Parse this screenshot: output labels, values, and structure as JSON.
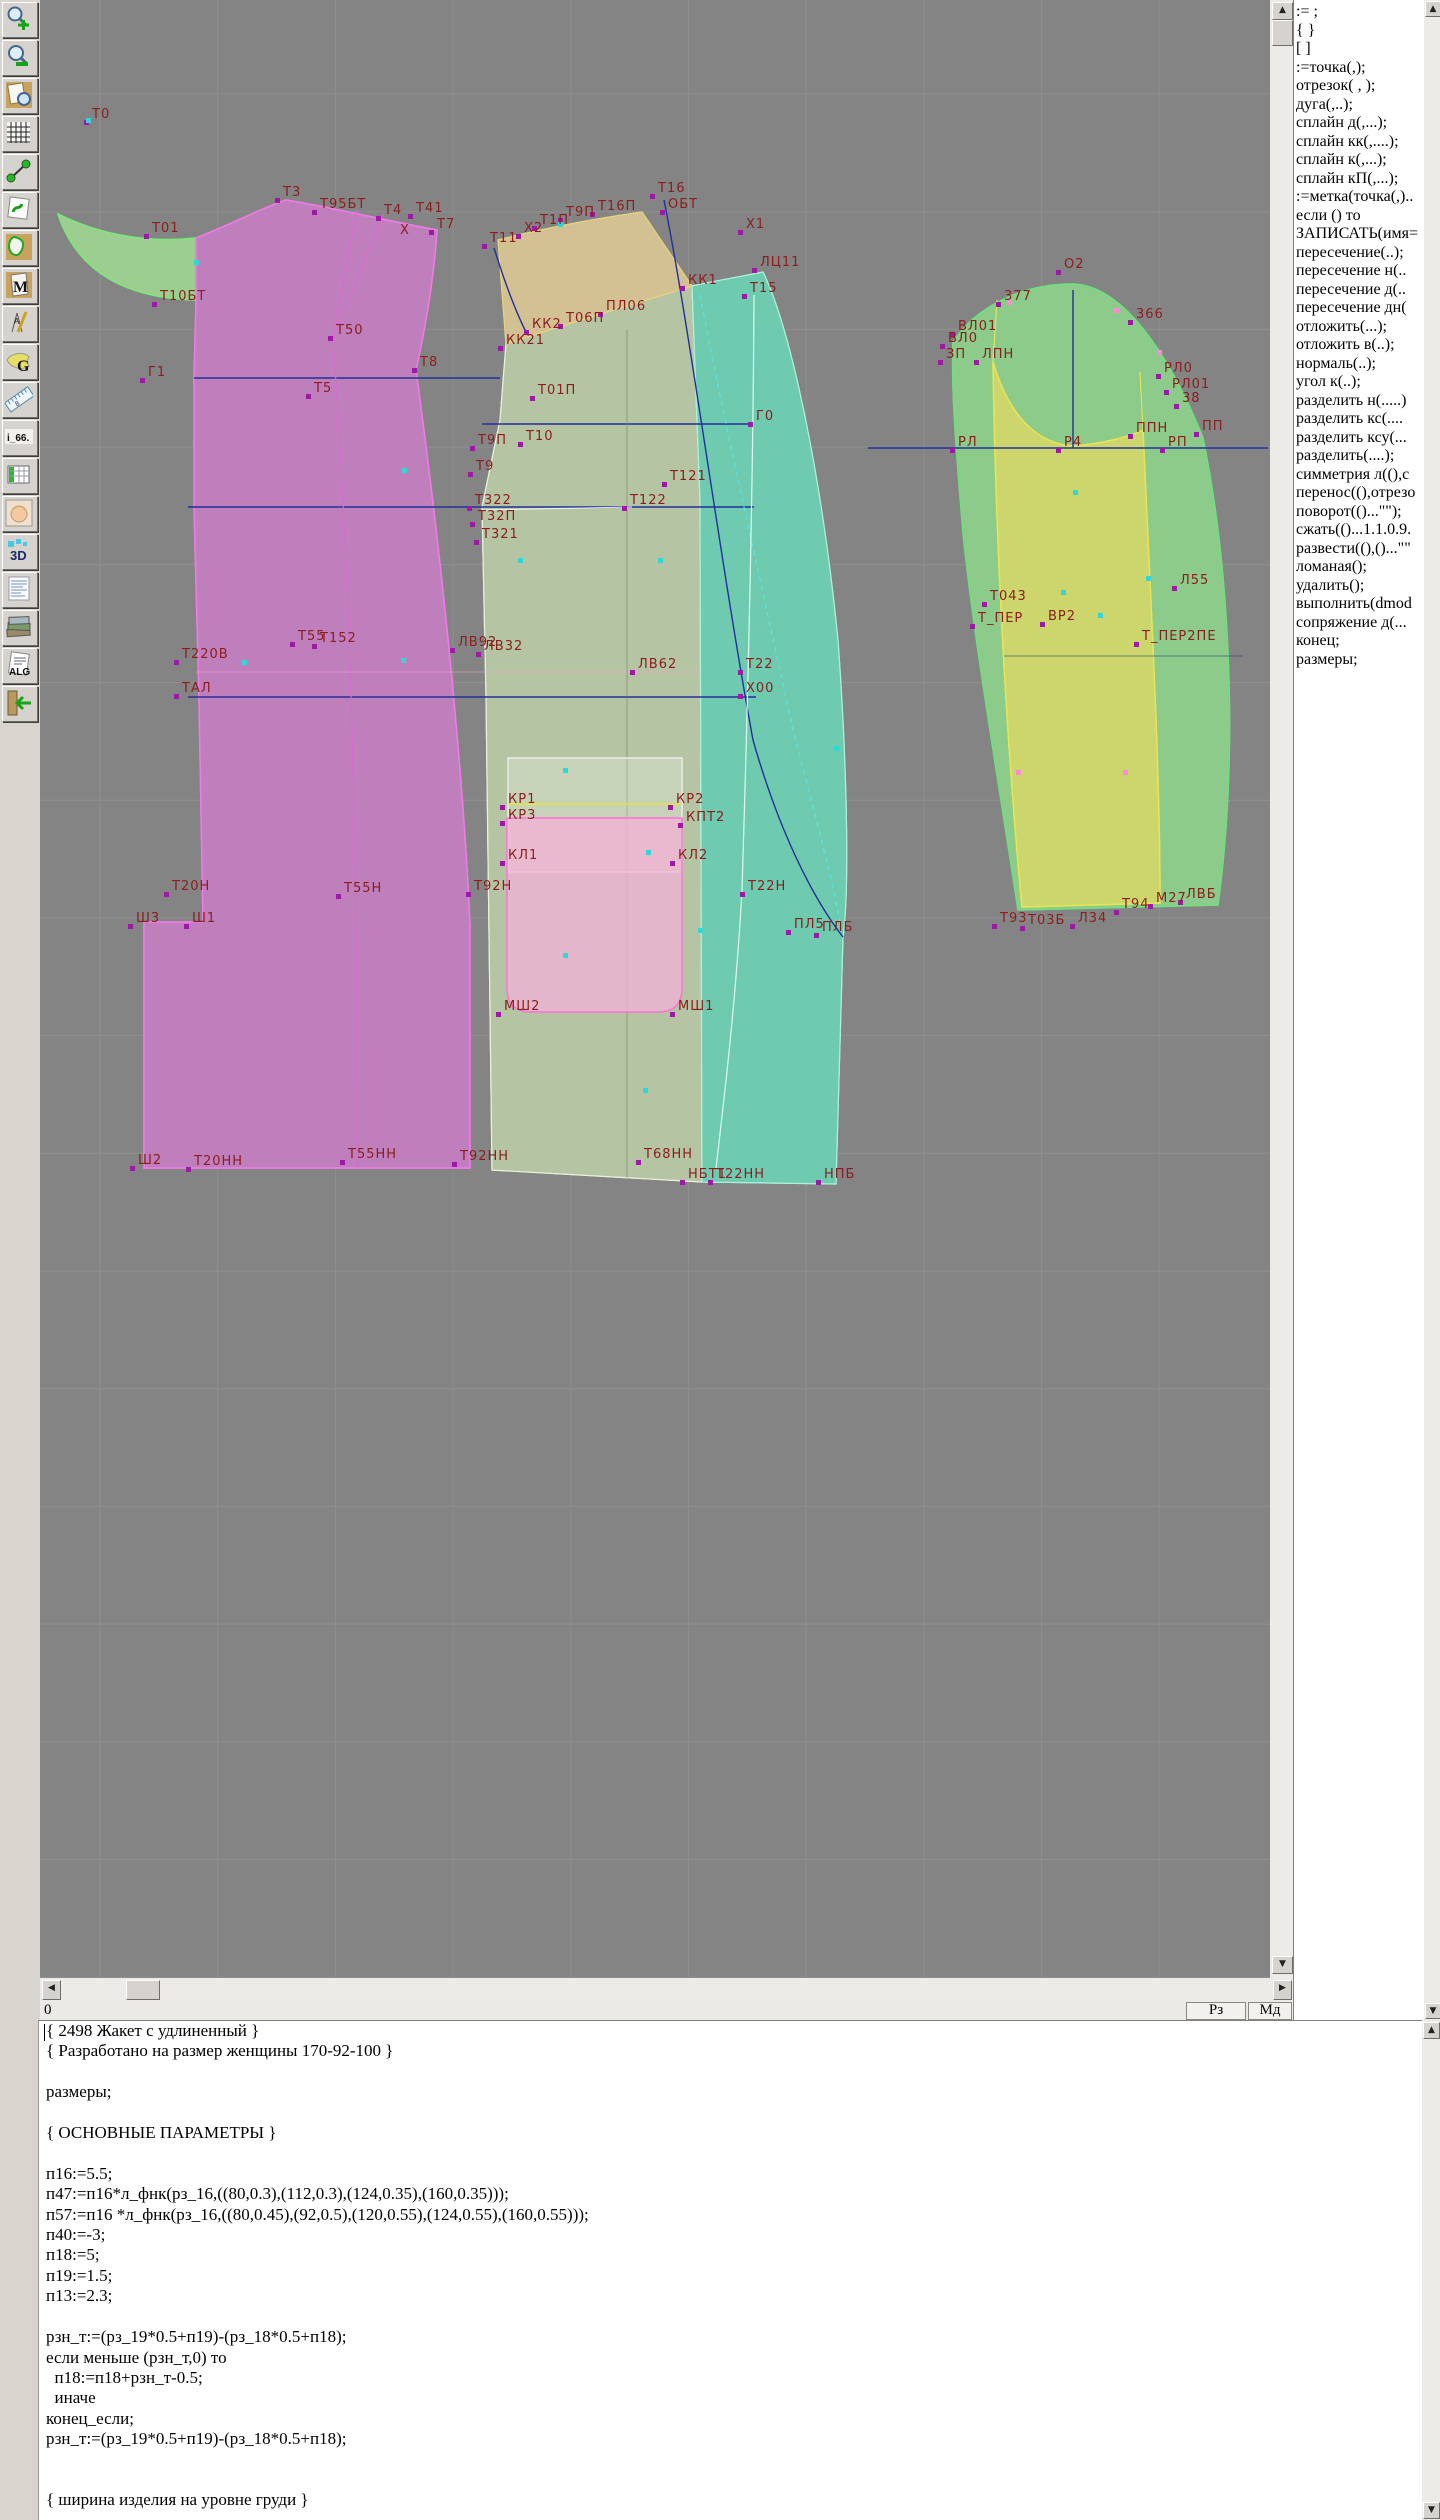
{
  "app": {
    "status_zero": "0",
    "btn_rz": "Рз",
    "btn_md": "Мд",
    "separator": "|"
  },
  "toolbar": {
    "items": [
      {
        "name": "zoom-in-button",
        "label": ""
      },
      {
        "name": "zoom-out-button",
        "label": ""
      },
      {
        "name": "print-preview-button",
        "label": ""
      },
      {
        "name": "grid-button",
        "label": ""
      },
      {
        "name": "measure-button",
        "label": ""
      },
      {
        "name": "sketch-button",
        "label": ""
      },
      {
        "name": "pattern-piece-button",
        "label": ""
      },
      {
        "name": "pattern-m-button",
        "label": "M"
      },
      {
        "name": "drafting-tools-button",
        "label": "A"
      },
      {
        "name": "graphics-g-button",
        "label": "G"
      },
      {
        "name": "ruler-button",
        "label": "8"
      },
      {
        "name": "i66-button",
        "label": "i_66."
      },
      {
        "name": "size-table-button",
        "label": ""
      },
      {
        "name": "model-photo-button",
        "label": ""
      },
      {
        "name": "threed-button",
        "label": "3D"
      },
      {
        "name": "document-list-button",
        "label": ""
      },
      {
        "name": "library-button",
        "label": ""
      },
      {
        "name": "algorithm-button",
        "label": "ALG"
      },
      {
        "name": "exit-button",
        "label": ""
      }
    ]
  },
  "right_panel": {
    "items": [
      ":= ;",
      "{  }",
      "[  ]",
      ":=точка(,);",
      "отрезок( , );",
      "дуга(,..);",
      "сплайн  д(,...);",
      "сплайн  кк(,....);",
      "сплайн  к(,...);",
      "сплайн  кП(,...);",
      ":=метка(точка(,)..",
      "если () то",
      "ЗАПИСАТЬ(имя=",
      "пересечение(..);",
      "пересечение  н(..",
      "пересечение  д(..",
      "пересечение  дн(",
      "отложить(...);",
      "отложить  в(..);",
      "нормаль(..);",
      "угол  к(..);",
      "разделить  н(.....)",
      "разделить  кс(....",
      "разделить  ксу(...",
      "разделить(....);",
      "симметрия  л((),с",
      "перенос((),отрезо",
      "поворот(()...\"\");",
      "сжать(()...1.1.0.9.",
      "развести((),()...\"\"",
      "ломаная();",
      "удалить();",
      "выполнить(dmod",
      "сопряжение  д(...",
      "конец;",
      "размеры;"
    ]
  },
  "canvas": {
    "colors": {
      "bg": "#848484",
      "grid": "#8f8f8f",
      "label": "#8b1d1d",
      "back": "#bf7fbc",
      "collar": "#9ccf8f",
      "side": "#b5c4a2",
      "shoulder": "#d3c193",
      "front": "#6fcbb0",
      "sleeve": "#8ccb8a",
      "undersleeve": "#ccd66b",
      "pocket": "#f0b4d6",
      "navy": "#223099",
      "cyan": "#5ee0dc",
      "magenta_pt": "#a018a8",
      "cyan_pt": "#2fd8d8",
      "pink_pt": "#ff8ad8"
    },
    "labels": [
      [
        "Т0",
        92,
        118
      ],
      [
        "Т3",
        283,
        196
      ],
      [
        "Т95БТ",
        320,
        208
      ],
      [
        "Т4",
        384,
        214
      ],
      [
        "Т41",
        416,
        212
      ],
      [
        "Х",
        400,
        234
      ],
      [
        "Т7",
        437,
        228
      ],
      [
        "Т01",
        152,
        232
      ],
      [
        "Т10БТ",
        160,
        300
      ],
      [
        "Т50",
        336,
        334
      ],
      [
        "Т8",
        420,
        366
      ],
      [
        "Т5",
        314,
        392
      ],
      [
        "Г1",
        148,
        376
      ],
      [
        "Т11",
        490,
        242
      ],
      [
        "Х2",
        524,
        232
      ],
      [
        "Т1П",
        540,
        224
      ],
      [
        "Т9П",
        566,
        216
      ],
      [
        "Т16П",
        598,
        210
      ],
      [
        "Т16",
        658,
        192
      ],
      [
        "ОБТ",
        668,
        208
      ],
      [
        "Х1",
        746,
        228
      ],
      [
        "ЛЦ11",
        760,
        266
      ],
      [
        "Т15",
        750,
        292
      ],
      [
        "КК1",
        688,
        284
      ],
      [
        "КК2",
        532,
        328
      ],
      [
        "КК21",
        506,
        344
      ],
      [
        "Т06П",
        566,
        322
      ],
      [
        "ПЛ06",
        606,
        310
      ],
      [
        "Т01П",
        538,
        394
      ],
      [
        "Т9П",
        478,
        444
      ],
      [
        "Т10",
        526,
        440
      ],
      [
        "Т9",
        476,
        470
      ],
      [
        "Г0",
        756,
        420
      ],
      [
        "Т322",
        475,
        504
      ],
      [
        "Т32П",
        478,
        520
      ],
      [
        "Т321",
        482,
        538
      ],
      [
        "Т121",
        670,
        480
      ],
      [
        "Т122",
        630,
        504
      ],
      [
        "Т55",
        298,
        640
      ],
      [
        "Т152",
        320,
        642
      ],
      [
        "ЛВ92",
        458,
        646
      ],
      [
        "ЛВ32",
        484,
        650
      ],
      [
        "Т220В",
        182,
        658
      ],
      [
        "ТАЛ",
        182,
        692
      ],
      [
        "ЛВ62",
        638,
        668
      ],
      [
        "Т22",
        746,
        668
      ],
      [
        "Х00",
        746,
        692
      ],
      [
        "КР1",
        508,
        803
      ],
      [
        "КР2",
        676,
        803
      ],
      [
        "КР3",
        508,
        819
      ],
      [
        "КПТ2",
        686,
        821
      ],
      [
        "КЛ1",
        508,
        859
      ],
      [
        "КЛ2",
        678,
        859
      ],
      [
        "Т20Н",
        172,
        890
      ],
      [
        "Т55Н",
        344,
        892
      ],
      [
        "Т92Н",
        474,
        890
      ],
      [
        "Т22Н",
        748,
        890
      ],
      [
        "Ш3",
        136,
        922
      ],
      [
        "Ш1",
        192,
        922
      ],
      [
        "ПЛ5",
        794,
        928
      ],
      [
        "ПЛБ",
        822,
        931
      ],
      [
        "МШ2",
        504,
        1010
      ],
      [
        "МШ1",
        678,
        1010
      ],
      [
        "Ш2",
        138,
        1164
      ],
      [
        "Т20НН",
        194,
        1165
      ],
      [
        "Т55НН",
        348,
        1158
      ],
      [
        "Т92НН",
        460,
        1160
      ],
      [
        "Т68НН",
        644,
        1158
      ],
      [
        "НБТ1",
        688,
        1178
      ],
      [
        "Т22НН",
        716,
        1178
      ],
      [
        "НПБ",
        824,
        1178
      ],
      [
        "О2",
        1064,
        268
      ],
      [
        "377",
        1004,
        300
      ],
      [
        "366",
        1136,
        318
      ],
      [
        "ВЛ01",
        958,
        330
      ],
      [
        "ВЛ0",
        948,
        342
      ],
      [
        "ЗП",
        946,
        358
      ],
      [
        "ЛПН",
        982,
        358
      ],
      [
        "РЛ0",
        1164,
        372
      ],
      [
        "РЛ01",
        1172,
        388
      ],
      [
        "38",
        1182,
        402
      ],
      [
        "ППН",
        1136,
        432
      ],
      [
        "ПП",
        1202,
        430
      ],
      [
        "РЛ",
        958,
        446
      ],
      [
        "Р4",
        1064,
        446
      ],
      [
        "РП",
        1168,
        446
      ],
      [
        "Л55",
        1180,
        584
      ],
      [
        "Т043",
        990,
        600
      ],
      [
        "Т_ПЕР",
        978,
        622
      ],
      [
        "ВР2",
        1048,
        620
      ],
      [
        "Т_ПЕР2ПЕ",
        1142,
        640
      ],
      [
        "Т93",
        1000,
        922
      ],
      [
        "Т03Б",
        1028,
        924
      ],
      [
        "Л34",
        1078,
        922
      ],
      [
        "Т94",
        1122,
        908
      ],
      [
        "М27",
        1156,
        902
      ],
      [
        "ЛВБ",
        1186,
        898
      ]
    ],
    "cyan_points": [
      [
        88,
        120
      ],
      [
        196,
        262
      ],
      [
        560,
        224
      ],
      [
        404,
        470
      ],
      [
        660,
        560
      ],
      [
        403,
        660
      ],
      [
        244,
        662
      ],
      [
        565,
        770
      ],
      [
        648,
        852
      ],
      [
        565,
        955
      ],
      [
        645,
        1090
      ],
      [
        1075,
        492
      ],
      [
        1063,
        592
      ],
      [
        1100,
        615
      ],
      [
        1148,
        578
      ],
      [
        700,
        930
      ],
      [
        520,
        560
      ],
      [
        836,
        748
      ]
    ],
    "pink_points": [
      [
        1009,
        302
      ],
      [
        1116,
        310
      ],
      [
        1159,
        352
      ],
      [
        1125,
        772
      ],
      [
        1018,
        772
      ]
    ]
  },
  "editor": {
    "lines": [
      "{ 2498 Жакет с удлиненный }",
      "{ Разработано на размер женщины 170-92-100 }",
      "",
      "размеры;",
      "",
      "{ ОСНОВНЫЕ ПАРАМЕТРЫ }",
      "",
      "п16:=5.5;",
      "п47:=п16*л_фнк(рз_16,((80,0.3),(112,0.3),(124,0.35),(160,0.35)));",
      "п57:=п16 *л_фнк(рз_16,((80,0.45),(92,0.5),(120,0.55),(124,0.55),(160,0.55)));",
      "п40:=-3;",
      "п18:=5;",
      "п19:=1.5;",
      "п13:=2.3;",
      "",
      "рзн_т:=(рз_19*0.5+п19)-(рз_18*0.5+п18);",
      "если меньше (рзн_т,0) то",
      "  п18:=п18+рзн_т-0.5;",
      "  иначе",
      "конец_если;",
      "рзн_т:=(рз_19*0.5+п19)-(рз_18*0.5+п18);",
      "",
      "",
      "{ ширина изделия на уровне груди }"
    ]
  }
}
